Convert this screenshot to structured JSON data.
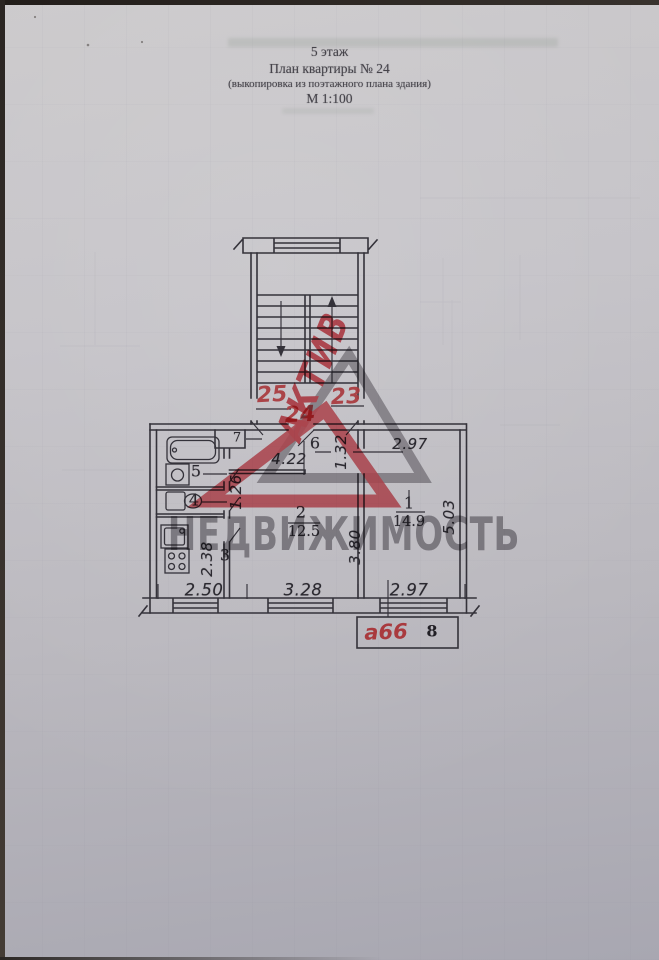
{
  "page": {
    "header": {
      "floor_line": "5  этаж",
      "title_line": "План квартиры № 24",
      "subtitle_line": "(выкопировка из поэтажного плана здания)",
      "scale_line": "М 1:100"
    },
    "plan": {
      "neighbor_apartment_left": "25",
      "apartment_number": "24",
      "neighbor_apartment_right": "23",
      "rooms": {
        "room1_number": "1",
        "room1_area": "14.9",
        "room2_number": "2",
        "room2_area": "12.5",
        "room3_number": "3",
        "room4_number": "4",
        "room5_number": "5",
        "room6_number": "6",
        "room7_number": "7"
      },
      "dimensions": {
        "hall_length": "4.22",
        "hall_width": "1.32",
        "room1_width": "2.97",
        "room1_length": "5.03",
        "room2_length": "3.80",
        "kitchen_width": "2.38",
        "sanitary_length": "1.26",
        "facade_kitchen": "2.50",
        "facade_room2": "3.28",
        "facade_room1": "2.97"
      }
    },
    "stamp": {
      "handwritten_code": "а66",
      "sheet_number": "8"
    },
    "watermark": {
      "brand_top": "АКТИВ",
      "brand_bottom": "НЕДВИЖИМОСТЬ"
    },
    "colors": {
      "ink": "#34323a",
      "annotation_red": "#a93a3e",
      "watermark_red": "#d8404a",
      "watermark_gray": "#8d8a90"
    }
  }
}
